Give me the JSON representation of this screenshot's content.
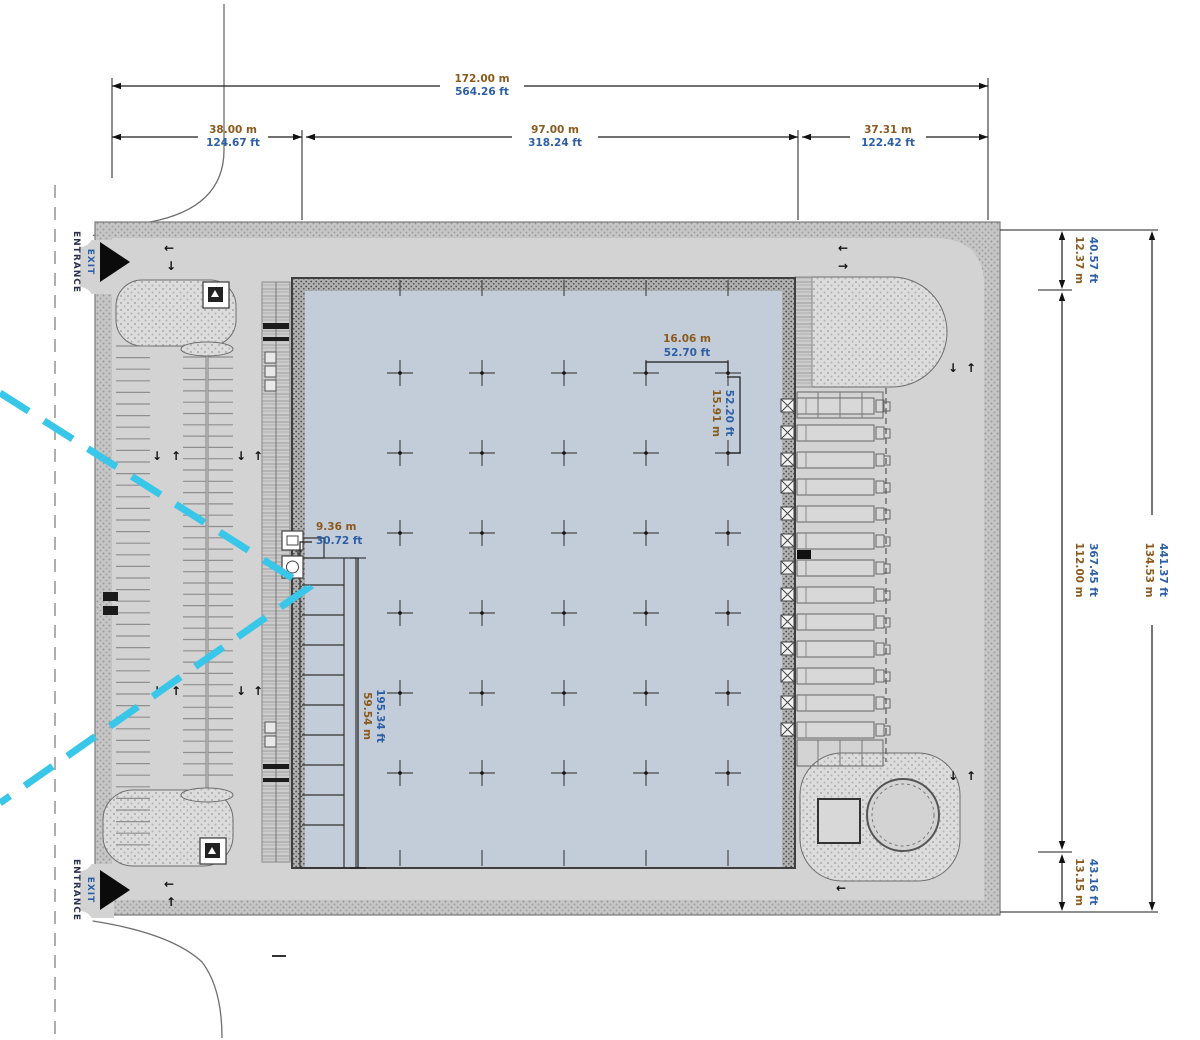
{
  "title": "Industrial building site plan",
  "colors": {
    "ground": "#d3d3d3",
    "building_fill": "#c3ccd9",
    "accent_cyan": "#38c6e9",
    "meters_text": "#8a5a1e",
    "feet_text": "#2d5fa6",
    "entrance_text": "#2b3050"
  },
  "labels": {
    "entrance": "ENTRANCE",
    "exit": "EXIT"
  },
  "icons": {
    "up": "↑",
    "down": "↓",
    "left": "←",
    "right": "→"
  },
  "dims": {
    "total_w": {
      "m": "172.00 m",
      "ft": "564.26 ft"
    },
    "w_left": {
      "m": "38.00 m",
      "ft": "124.67 ft"
    },
    "w_mid": {
      "m": "97.00 m",
      "ft": "318.24 ft"
    },
    "w_right": {
      "m": "37.31 m",
      "ft": "122.42 ft"
    },
    "h_top": {
      "m": "12.37 m",
      "ft": "40.57 ft"
    },
    "h_mid": {
      "m": "112.00 m",
      "ft": "367.45 ft"
    },
    "h_bottom": {
      "m": "13.15 m",
      "ft": "43.16 ft"
    },
    "total_h": {
      "m": "134.53 m",
      "ft": "441.37 ft"
    },
    "bay_w": {
      "m": "16.06 m",
      "ft": "52.70 ft"
    },
    "bay_h": {
      "m": "15.91 m",
      "ft": "52.20 ft"
    },
    "office_w": {
      "m": "9.36 m",
      "ft": "30.72 ft"
    },
    "office_l": {
      "m": "59.54 m",
      "ft": "195.34 ft"
    }
  },
  "plan": {
    "left_stall_rows": 44,
    "island_stall_rows": 38,
    "dock_bays": 13,
    "grid_columns": 5,
    "grid_rows": 6,
    "office_partitions": 9
  }
}
